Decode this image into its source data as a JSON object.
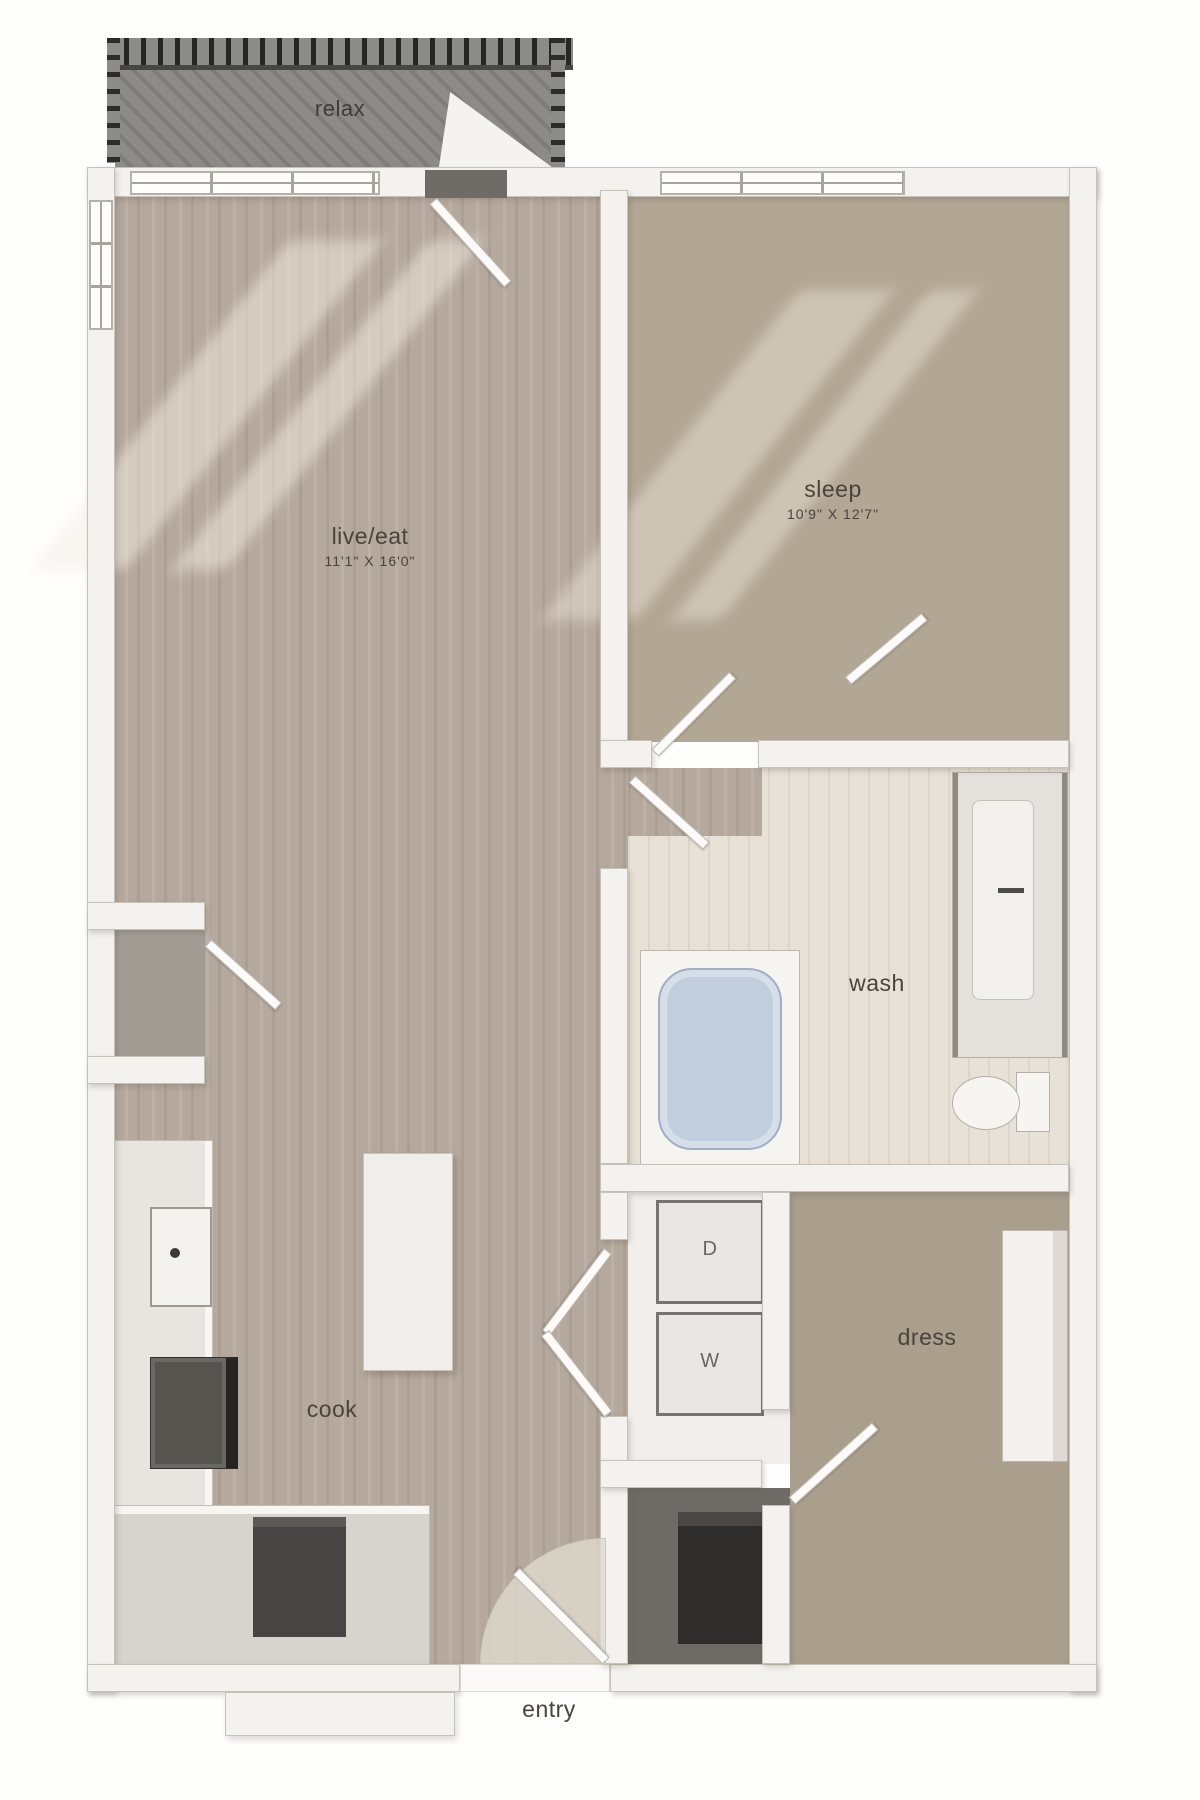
{
  "rooms": {
    "relax": {
      "label": "relax"
    },
    "live_eat": {
      "label": "live/eat",
      "dims": "11'1\" X 16'0\""
    },
    "sleep": {
      "label": "sleep",
      "dims": "10'9\" X 12'7\""
    },
    "wash": {
      "label": "wash"
    },
    "dress": {
      "label": "dress"
    },
    "cook": {
      "label": "cook"
    },
    "entry": {
      "label": "entry"
    }
  },
  "appliances": {
    "dryer_label": "D",
    "washer_label": "W"
  },
  "colors": {
    "wood": "#b5a89c",
    "sleep-carpet": "#b2a695",
    "dress-carpet": "#aa9e8d",
    "tile": "#e8e1d8",
    "balcony": "#8d8b88",
    "tub": "#c0cedd",
    "wall": "#f4f2ee",
    "text": "#49443c",
    "dark": "#3a3836"
  }
}
